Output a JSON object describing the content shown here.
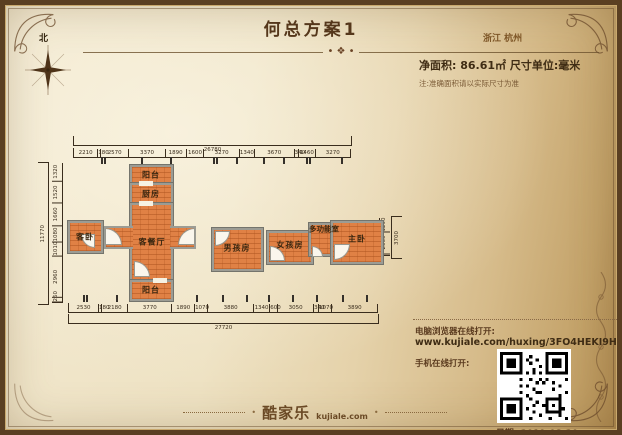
{
  "header": {
    "title": "何总方案1",
    "location": "浙江 杭州",
    "north_label": "北",
    "area_line": "净面积: 86.61㎡  尺寸单位:毫米",
    "note": "注:准确面积请以实际尺寸为准"
  },
  "rooms": [
    {
      "label": "阳台"
    },
    {
      "label": "厨房"
    },
    {
      "label": "客餐厅"
    },
    {
      "label": "阳台"
    },
    {
      "label": "客卧"
    },
    {
      "label": "男孩房"
    },
    {
      "label": "女孩房"
    },
    {
      "label": "多功能室"
    },
    {
      "label": "主卧"
    }
  ],
  "dims": {
    "top": {
      "total": "26780",
      "segments": [
        "2210",
        "180",
        "2570",
        "3370",
        "1890",
        "1600",
        "3270",
        "1340",
        "3670",
        "340",
        "1460",
        "3270"
      ]
    },
    "bottom": {
      "total": "27720",
      "segments": [
        "2530",
        "180",
        "2180",
        "3770",
        "1890",
        "1070",
        "3880",
        "1340",
        "600",
        "3050",
        "340",
        "1070",
        "3890"
      ]
    },
    "left": {
      "total": "11770",
      "segments": [
        "1320",
        "1520",
        "1660",
        "1080",
        "1010",
        "2960",
        "260"
      ]
    },
    "right": {
      "total": "3700",
      "segments": [
        "1290",
        "2060"
      ]
    }
  },
  "footer": {
    "logo_cn": "酷家乐",
    "logo_domain": "kujiale.com",
    "browser_label": "电脑浏览器在线打开:",
    "url": "www.kujiale.com/huxing/3FO4HEKI9H4T",
    "mobile_label": "手机在线打开:",
    "date": "日期: 2019-08-20"
  },
  "colors": {
    "accent": "#6b4a2b",
    "room_fill": "#e08145",
    "wall": "#9c9c94",
    "text_dark": "#42301a"
  }
}
